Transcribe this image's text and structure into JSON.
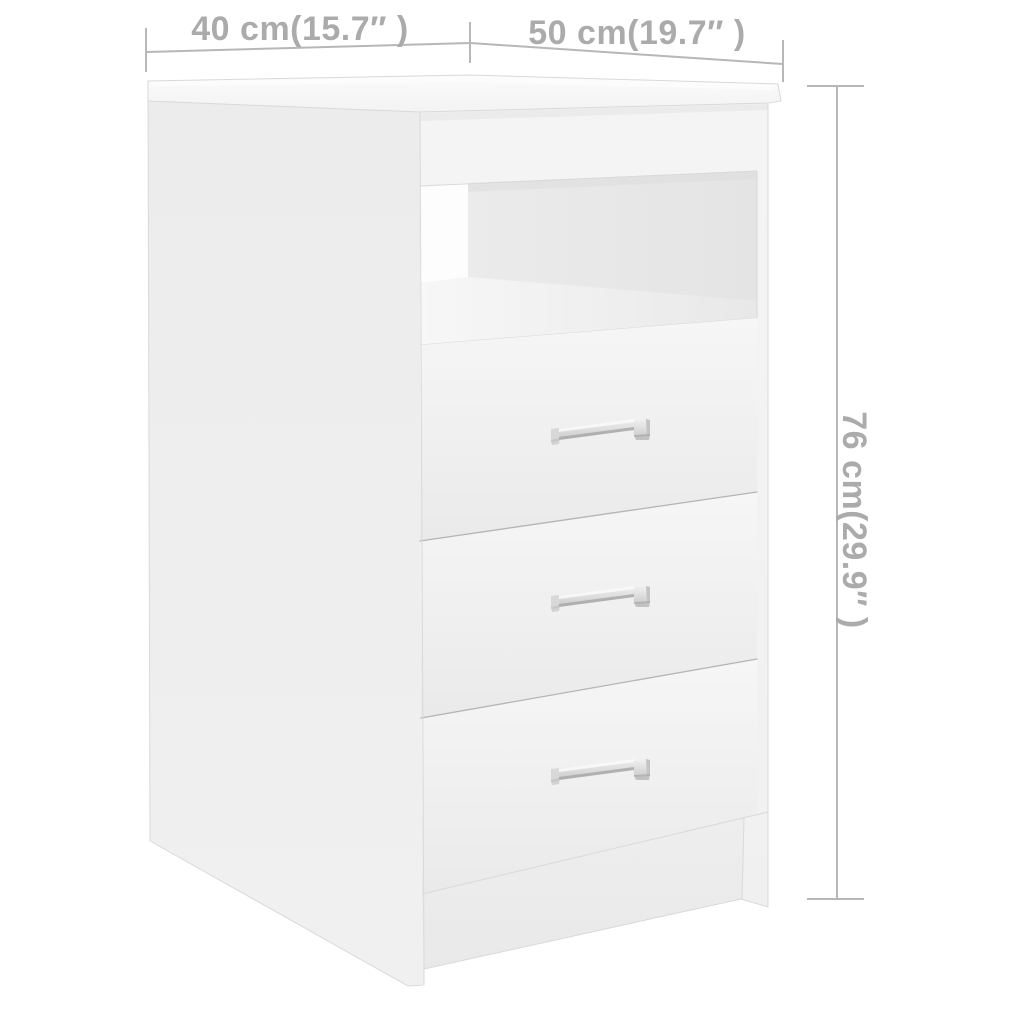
{
  "canvas": {
    "width": 1024,
    "height": 1024
  },
  "annotations": {
    "top_left_dimension": "40 cm(15.7″ )",
    "top_right_dimension": "50 cm(19.7″ )",
    "side_dimension": "76 cm(29.9″ )"
  },
  "cabinet": {
    "drawer_count": 3,
    "handle_count": 3,
    "open_compartment_count": 1
  },
  "colors": {
    "background": "#ffffff",
    "dimension_line": "#b7b7b7",
    "dimension_text": "#ababab",
    "cabinet_edge": "#d9d9d9",
    "drawer_gap_line": "#aaaaaa",
    "side_panel": "#ededed",
    "front_face": "#f2f2f2",
    "top_panel": "#f8f8f8",
    "compartment_back": "#e7e7e7",
    "compartment_highlight": "#fdfdfd",
    "handle_chrome": "#d9d9d9"
  }
}
